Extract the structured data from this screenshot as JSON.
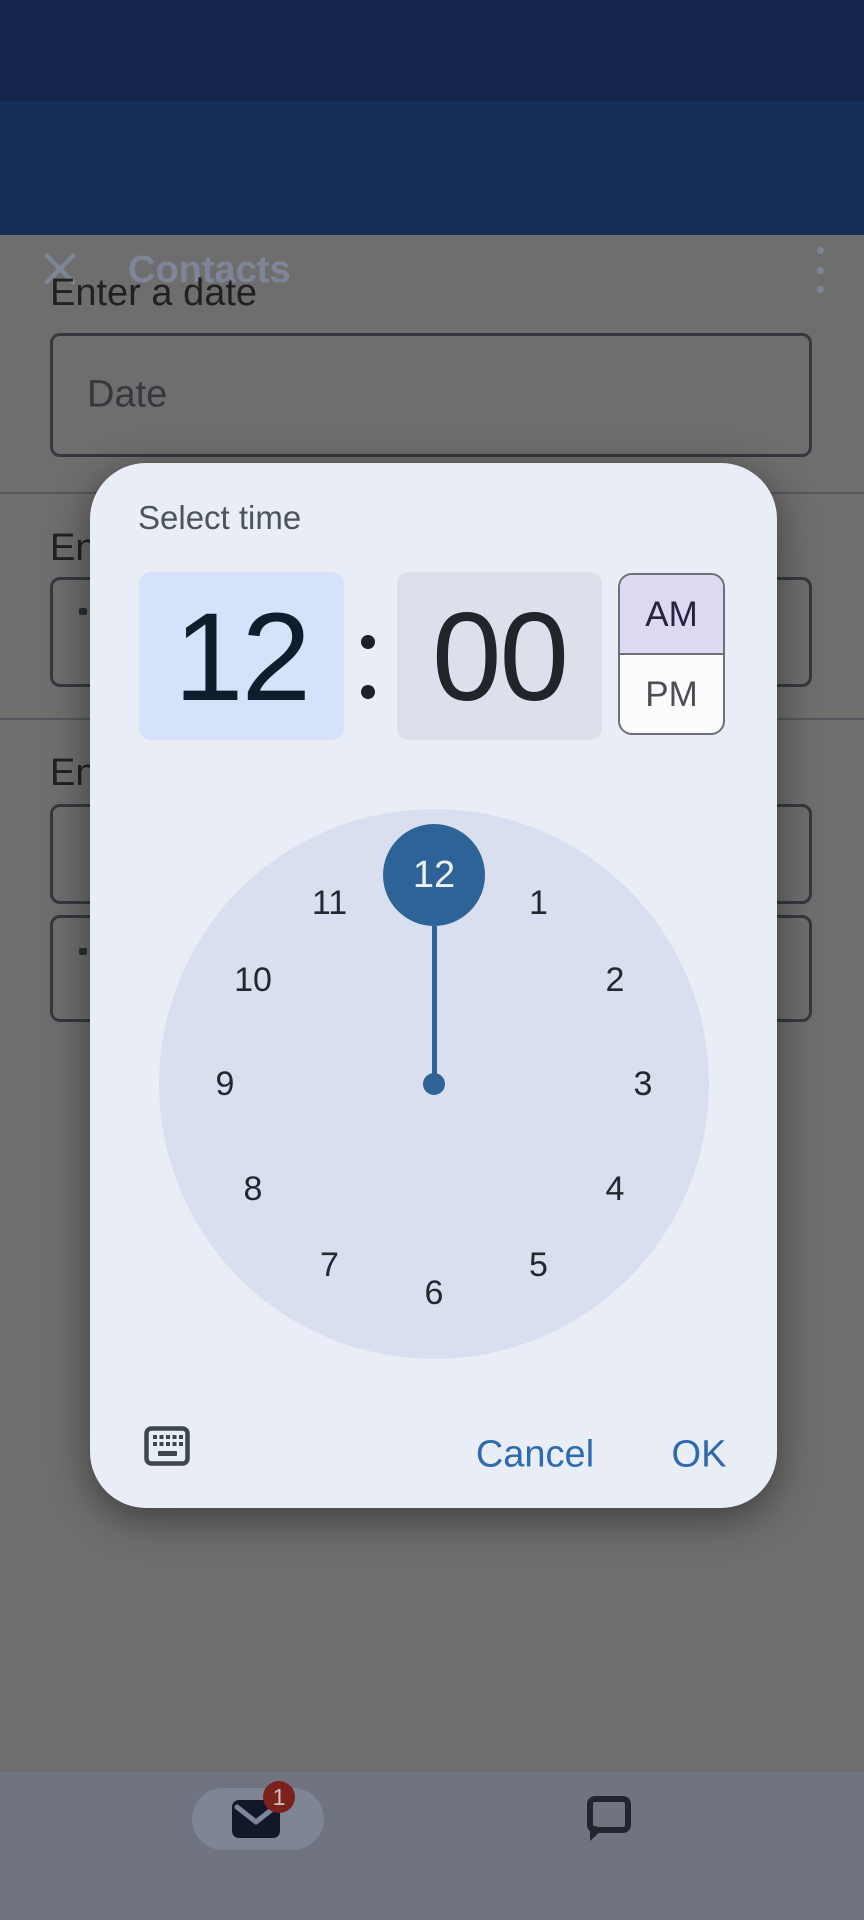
{
  "app_bar": {
    "title": "Contacts"
  },
  "form": {
    "date_label": "Enter a date",
    "date_placeholder": "Date",
    "time_label_partial_1": "En",
    "time_label_partial_2": "En"
  },
  "bottom_nav": {
    "mail_badge": "1"
  },
  "dialog": {
    "title": "Select time",
    "time": {
      "hour": "12",
      "minute": "00"
    },
    "period": {
      "am": "AM",
      "pm": "PM",
      "selected": "AM"
    },
    "clock": {
      "numbers": [
        "12",
        "1",
        "2",
        "3",
        "4",
        "5",
        "6",
        "7",
        "8",
        "9",
        "10",
        "11"
      ],
      "selected": "12"
    },
    "actions": {
      "cancel": "Cancel",
      "ok": "OK"
    },
    "colors": {
      "primary": "#2e6398",
      "hour_cell_bg": "#d5e2fa",
      "minute_cell_bg": "#dbe0eb",
      "am_selected_bg": "#ded9f2",
      "dialog_bg": "#e9eef6",
      "clock_face_bg": "#d9dfee",
      "action_text": "#2e6bae",
      "app_bar_bg": "#172e58",
      "status_bar_bg": "#13254a"
    }
  }
}
